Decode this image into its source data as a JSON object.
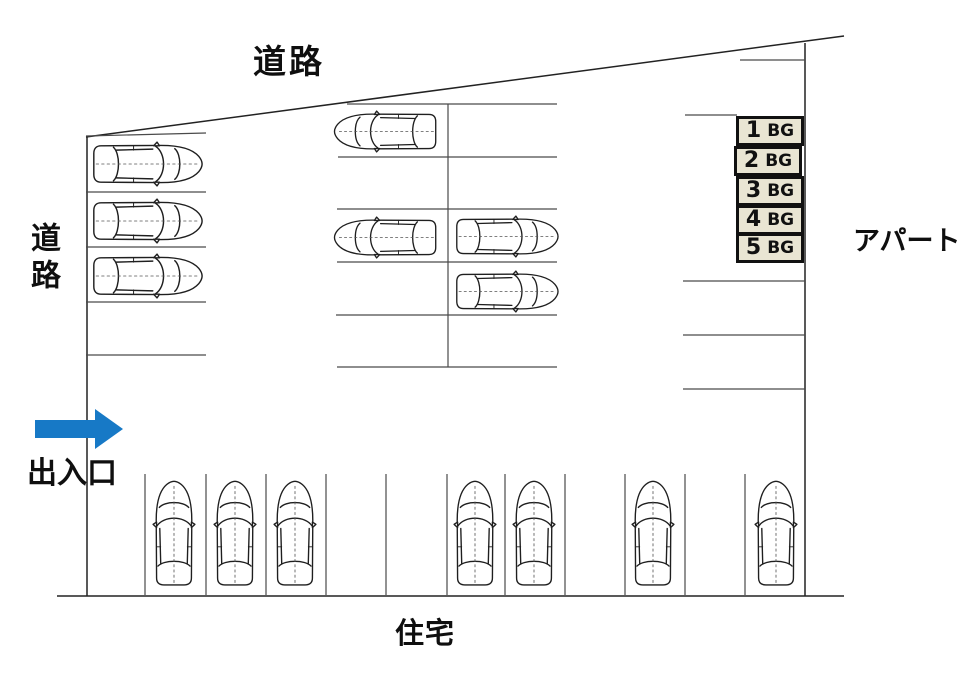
{
  "diagram": {
    "type": "parking-lot-layout",
    "labels": {
      "road_top": "道路",
      "road_left": "道路",
      "entrance": "出入口",
      "apartment": "アパート",
      "residence": "住宅"
    },
    "entrance_arrow": {
      "direction": "right",
      "color": "#1779c6"
    },
    "numbered_spaces": [
      {
        "number": "1",
        "suffix": "BG"
      },
      {
        "number": "2",
        "suffix": "BG"
      },
      {
        "number": "3",
        "suffix": "BG"
      },
      {
        "number": "4",
        "suffix": "BG"
      },
      {
        "number": "5",
        "suffix": "BG"
      }
    ],
    "colors": {
      "space_box_fill": "#e9e5d3",
      "line_color": "#2b2b2b"
    }
  }
}
